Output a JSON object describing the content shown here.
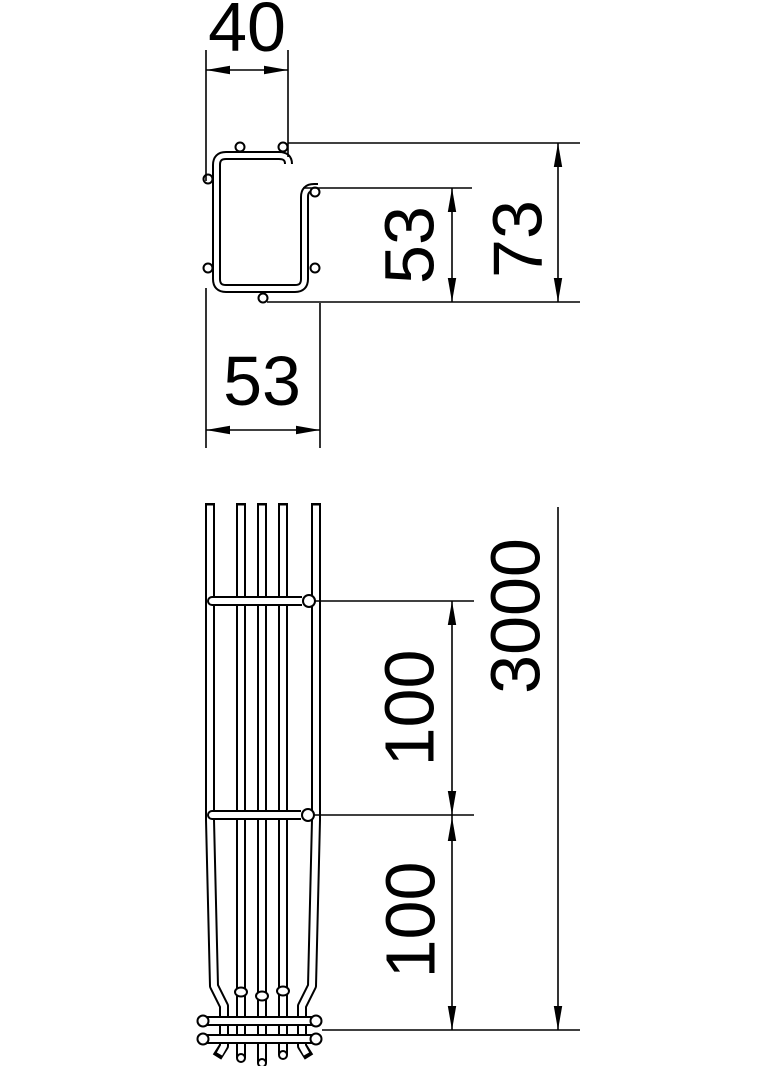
{
  "drawing": {
    "colors": {
      "line": "#000000",
      "background": "#ffffff"
    },
    "cross_section": {
      "dim_top_width": "40",
      "dim_side_height": "53",
      "dim_total_height": "73",
      "dim_outer_width": "53"
    },
    "side_view": {
      "dim_rung_spacing_upper": "100",
      "dim_rung_spacing_lower": "100",
      "dim_total_length": "3000"
    }
  }
}
